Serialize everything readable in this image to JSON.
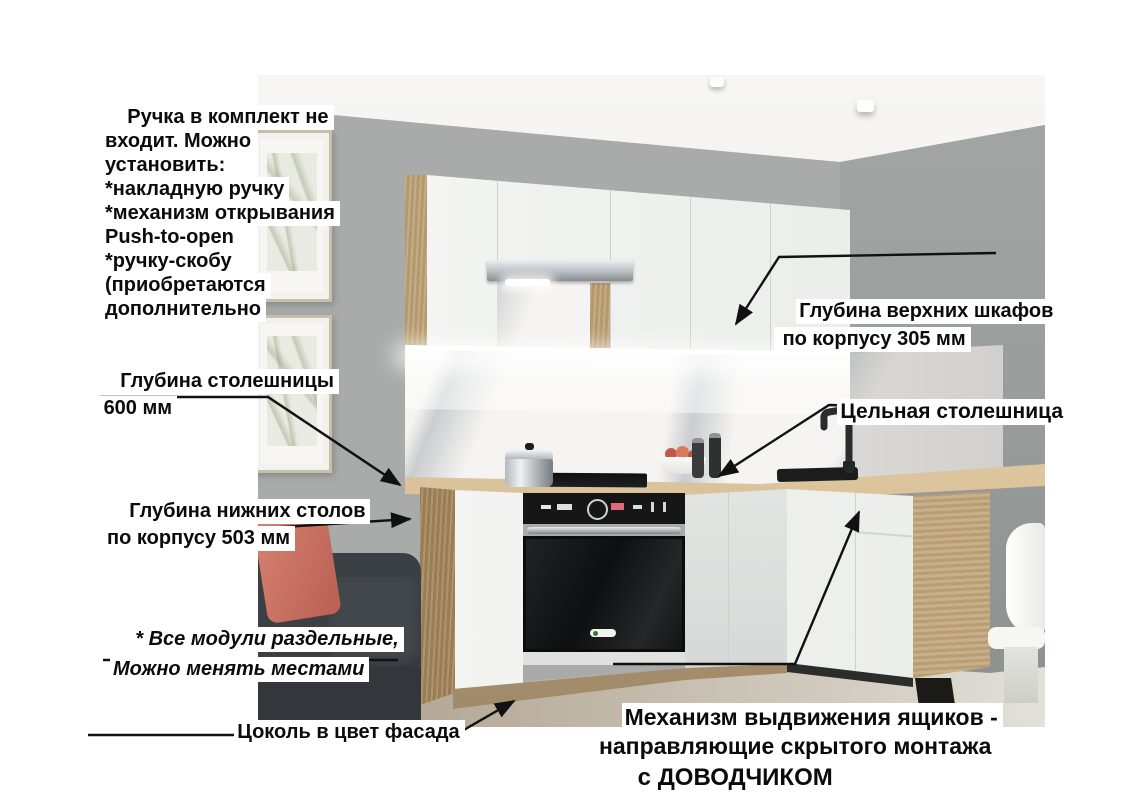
{
  "annotations": {
    "handle_note": {
      "text": "Ручка в комплект не\nвходит. Можно\nустановить:\n*накладную ручку\n*механизм открывания\nPush-to-open\n*ручку-скобу\n(приобретаются\nдополнительно"
    },
    "countertop_depth": {
      "text": "Глубина столешницы\n 600 мм"
    },
    "base_cabinet_depth": {
      "text": "Глубина нижних столов\nпо корпусу 503 мм"
    },
    "modules_note": {
      "text": "* Все модули раздельные,\nМожно менять местами"
    },
    "plinth_note": {
      "text": "Цоколь в цвет фасада"
    },
    "upper_cabinet_depth": {
      "text": "Глубина верхних шкафов\n по корпусу 305 мм"
    },
    "solid_countertop": {
      "text": "Цельная столешница"
    },
    "drawer_mechanism": {
      "text": "Механизм выдвижения ящиков -\nнаправляющие скрытого монтажа"
    },
    "soft_close": {
      "text": "с ДОВОДЧИКОМ"
    }
  },
  "colors": {
    "label_bg": "#ffffff",
    "label_text": "#0b0b0b",
    "line": "#111111",
    "wall": "#a8aba9",
    "wall_right": "#9aa09e",
    "ceiling": "#f4f3f1",
    "cabinet_white": "#f3f4f2",
    "wood": "#bfa377",
    "countertop": "#dcc49c",
    "marble": "#f5f4f2",
    "oven_black": "#161616",
    "sofa": "#3b4044",
    "pillow": "#cf7767",
    "floor": "#bfb3a1"
  }
}
